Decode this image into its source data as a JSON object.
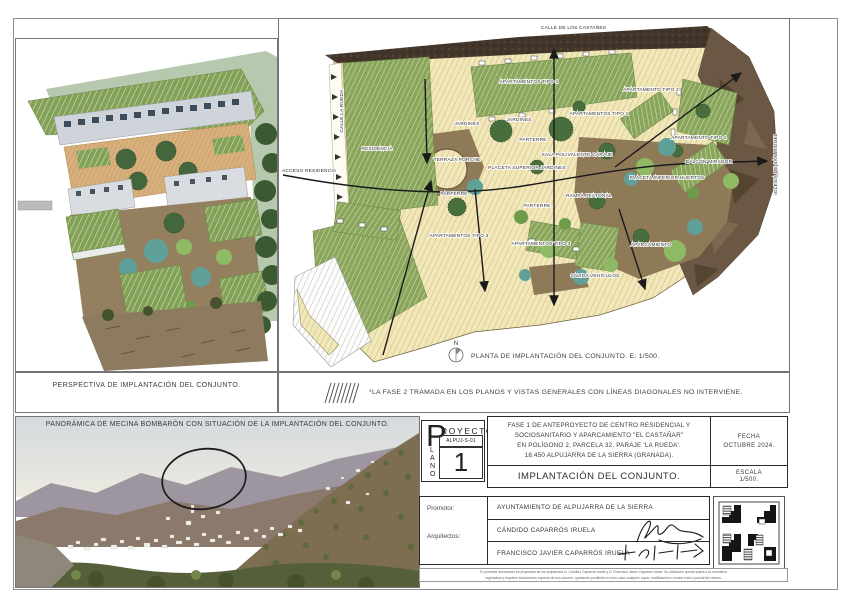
{
  "colors": {
    "paper": "#ffffff",
    "frame_line": "#757575",
    "paving_cream": "#f1e7b8",
    "building_green": "#8aa65b",
    "plaza_brown": "#8f7a58",
    "street_dark": "#43352a",
    "rock_brown": "#6a5844",
    "tree_green": "#486e3e",
    "lawn_teal": "#5fa199",
    "text_dark": "#333333"
  },
  "perspective": {
    "caption": "PERSPECTIVA DE IMPLANTACIÓN DEL CONJUNTO."
  },
  "plan": {
    "caption": "PLANTA DE IMPLANTACIÓN DEL CONJUNTO. E: 1/500.",
    "north": "N",
    "labels": {
      "calle_top": "CALLE DE LOS CASTAÑES",
      "calle_left": "CALLE LA RUEDA",
      "iglesia": "IGLESIA DE SAN MIGUEL",
      "acceso": "ACCESO RESIDENCIA",
      "residencia": "RESIDENCIA",
      "terraza": "TERRAZA PORCHE",
      "placeta_superior": "PLACETA SUPERIOR JARDINES",
      "sala": "SALA POLIVALENTE GARAJE",
      "apartamentos1": "APARTAMENTOS TIPO 1",
      "apartamento2": "APARTAMENTO TIPO 2",
      "apartamentos3": "APARTAMENTOS TIPO 3",
      "jardines": "JARDINES",
      "parterre": "PARTERRE",
      "placeta_inferior": "PLACETA INFERIOR HUERTOS",
      "balcon": "BALCÓN MIRADOR",
      "rampa": "RAMPA PEATONAL",
      "salida": "SALIDA VEHÍCULOS",
      "aparcamiento": "APARCAMIENTO"
    }
  },
  "note": {
    "text": "*LA FASE 2 TRAMADA EN LOS PLANOS Y VISTAS GENERALES CON LÍNEAS DIAGONALES NO INTERVIENE."
  },
  "photo": {
    "caption": "PANORÁMICA DE MECINA BOMBARÓN CON SITUACIÓN DE LA IMPLANTACIÓN DEL CONJUNTO."
  },
  "titleblock": {
    "p_initial": "P",
    "royecto": "ROYECTO",
    "lano": [
      "L",
      "A",
      "N",
      "O"
    ],
    "code": "ALPUJ-S-01",
    "number": "1",
    "description_lines": [
      "FASE 1 DE ANTEPROYECTO DE CENTRO RESIDENCIAL Y",
      "SOCIOSANITARIO Y APARCAMIENTO \"EL CASTAÑAR\"",
      "EN POLÍGONO 2, PARCELA 32, PARAJE 'LA RUEDA'.",
      "18.450 ALPUJARRA DE LA SIERRA (GRANADA)."
    ],
    "title": "IMPLANTACIÓN DEL CONJUNTO.",
    "fecha_label": "FECHA",
    "fecha_value": "OCTUBRE 2024.",
    "escala_label": "ESCALA",
    "escala_value": "1/500.",
    "promotor_label": "Promotor:",
    "promotor_value": "AYUNTAMIENTO DE ALPUJARRA DE LA SIERRA",
    "arquitectos_label": "Arquitectos:",
    "arquitecto1": "CÁNDIDO CAPARRÓS IRUELA",
    "arquitecto2": "FRANCISCO JAVIER CAPARRÓS IRUELA",
    "fine_print": [
      "El presente documento es propiedad de los arquitectos D. Cándido Caparrós Iruela y D. Francisco Javier Caparrós Iruela. Su utilización queda sujeta a la normativa",
      "reguladora y requiere autorización expresa de sus autores, quedando prohibida en todo caso cualquier copia, modificación o cesión total o parcial del mismo."
    ]
  }
}
